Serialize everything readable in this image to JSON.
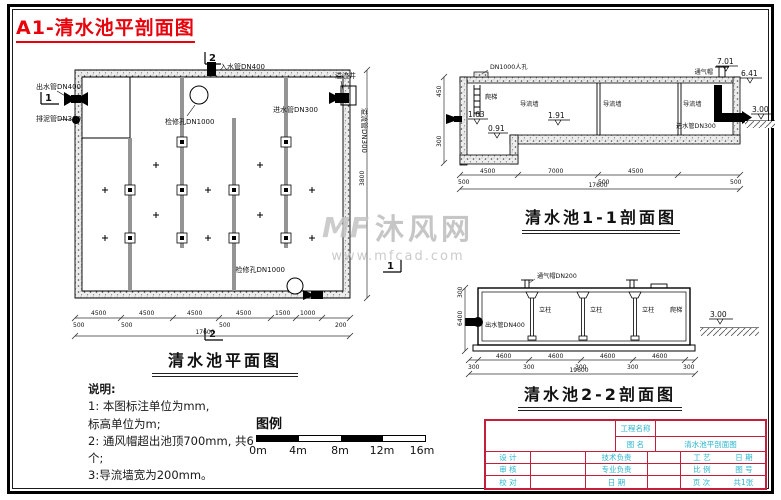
{
  "page": {
    "title": "A1-清水池平剖面图"
  },
  "watermark": {
    "logo": "MF",
    "name": "沐风网",
    "url": "www.mfcad.com"
  },
  "plan": {
    "caption": "清水池平面图",
    "labels": {
      "outlet": "出水管DN400",
      "drain": "排泥管DN300",
      "manhole_top": "检修孔DN1000",
      "inlet_top": "入水管DN400",
      "overflow_well": "溢流井",
      "inlet_right": "进水管DN300",
      "overflow_pipe": "溢流管DN300",
      "manhole_bottom": "检修孔DN1000"
    },
    "markers": {
      "left": "1",
      "right": "1",
      "top": "2",
      "bottom": "2"
    },
    "dim_side": "3800",
    "dims_above": [
      "4500",
      "4500",
      "4500",
      "4500",
      "1500",
      "1000"
    ],
    "dims_below": [
      "500",
      "500",
      "500",
      "200"
    ],
    "dim_total": "17600"
  },
  "section1": {
    "caption": "清水池1-1剖面图",
    "labels": {
      "manhole": "DN1000人孔",
      "ladder": "爬梯",
      "wall1": "导流墙",
      "wall2": "导流墙",
      "wall3": "导流墙",
      "vent": "通气帽",
      "inlet": "进水管DN300"
    },
    "elev": {
      "e701": "7.01",
      "e641": "6.41",
      "e300": "3.00",
      "e191": "1.91",
      "e163": "1.63",
      "e091": "0.91"
    },
    "side_dims": [
      "450",
      "300"
    ],
    "dims_above": [
      "4500",
      "7000",
      "4500"
    ],
    "dims_below": [
      "500",
      "500",
      "500"
    ],
    "dim_total": "17600"
  },
  "section2": {
    "caption": "清水池2-2剖面图",
    "labels": {
      "vent": "通气帽DN200",
      "outlet": "出水管DN400",
      "col1": "立柱",
      "col2": "立柱",
      "col3": "立柱",
      "ladder": "爬梯"
    },
    "elev": "3.00",
    "side_dims": [
      "300",
      "6400"
    ],
    "dims_above": [
      "4600",
      "4600",
      "4600",
      "4600"
    ],
    "dims_below": [
      "300",
      "300",
      "300",
      "300",
      "300"
    ],
    "dim_total": "19600"
  },
  "notes": {
    "heading": "说明:",
    "lines": [
      "1: 本图标注单位为mm,",
      "标高单位为m;",
      "2: 通风帽超出池顶700mm, 共6",
      "个;",
      "3:导流墙宽为200mm。"
    ]
  },
  "scalebar": {
    "legend": "图例",
    "ticks": [
      "0m",
      "4m",
      "8m",
      "12m",
      "16m"
    ]
  },
  "titleblock": {
    "project_label": "工程名称",
    "name_label": "图 名",
    "drawing_name": "清水池平剖面图",
    "rows": [
      {
        "l": "设 计",
        "m": "技术负责",
        "r1": "工 艺",
        "r2": "日 期"
      },
      {
        "l": "审 核",
        "m": "专业负责",
        "r1": "比 例",
        "r2": "图 号"
      },
      {
        "l": "校 对",
        "m": "日 期",
        "r1": "页 次",
        "r2": "共1张"
      }
    ]
  }
}
